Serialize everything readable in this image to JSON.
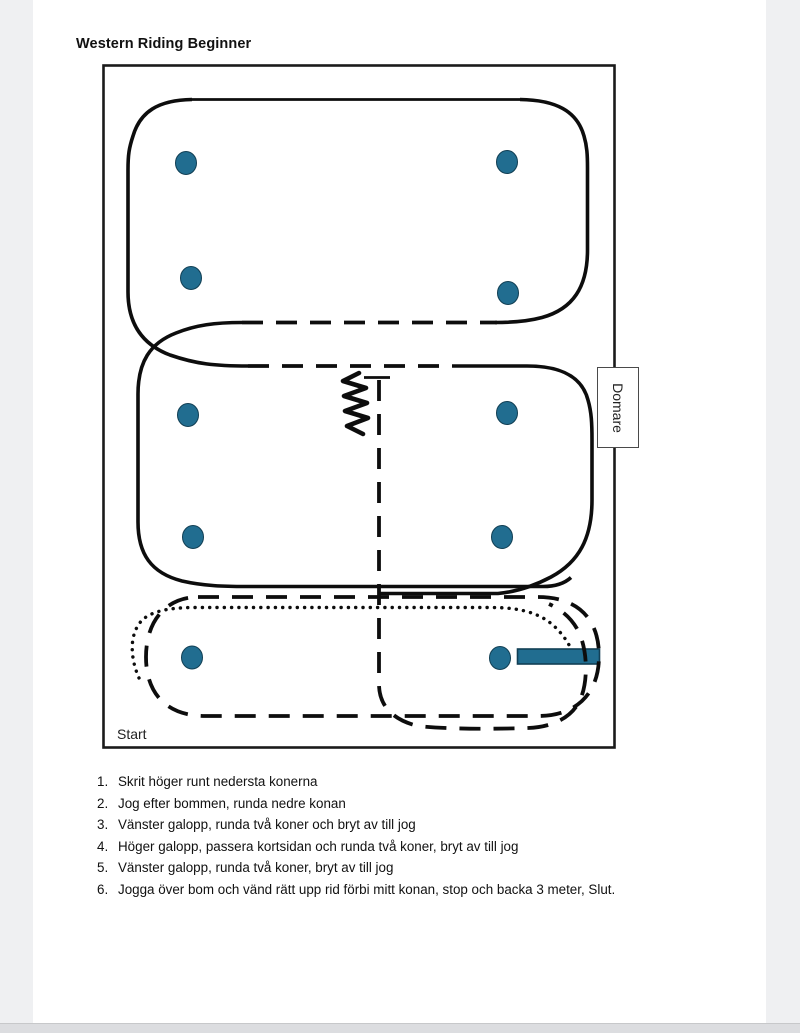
{
  "page": {
    "title": "Western Riding Beginner"
  },
  "diagram": {
    "start_label": "Start",
    "judge_label": "Domare",
    "cone_count": 10,
    "elements": {
      "cone_marker": "teal-ellipse-cone",
      "pole_bom": "teal-horizontal-bar",
      "walk_line_style": "dotted",
      "jog_line_style": "dashed",
      "lope_line_style": "solid",
      "backup_symbol": "zigzag"
    }
  },
  "colors": {
    "cone": "#216d90",
    "pole_border": "#123f55",
    "ink": "#111111",
    "page_bg": "#ffffff",
    "margin_bg": "#eff0f2",
    "footer_strip": "#dcdde0"
  },
  "instructions": {
    "items": [
      {
        "num": "1.",
        "text": "Skrit höger runt nedersta konerna"
      },
      {
        "num": "2.",
        "text": "Jog efter bommen, runda nedre konan"
      },
      {
        "num": "3.",
        "text": "Vänster galopp, runda två koner och bryt av till jog"
      },
      {
        "num": "4.",
        "text": "Höger galopp, passera kortsidan och runda två koner, bryt av till jog"
      },
      {
        "num": "5.",
        "text": "Vänster galopp, runda två koner, bryt av till jog"
      },
      {
        "num": "6.",
        "text": "Jogga över bom och vänd rätt upp rid förbi mitt konan, stop och backa 3 meter, Slut."
      }
    ]
  }
}
